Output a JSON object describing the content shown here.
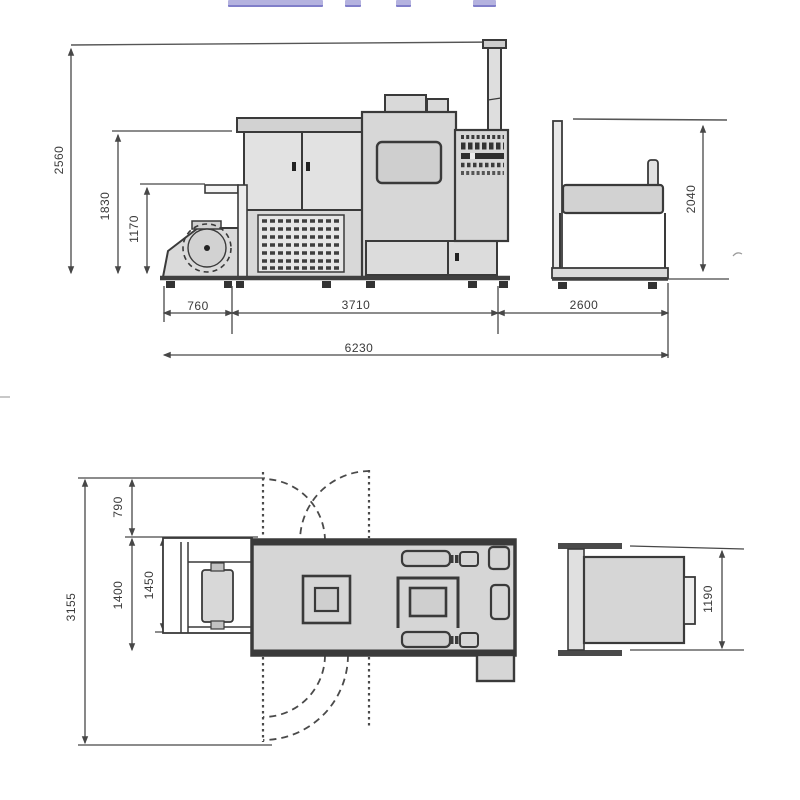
{
  "colors": {
    "accent_bar": "#b4b2df",
    "accent_bar_edge": "#807ec9",
    "machine_fill": "#d6d6d6",
    "outline": "#3a3a3a",
    "dimension_line": "#474747"
  },
  "elevation_view": {
    "dims": {
      "height_overall": "2560",
      "height_body": "1830",
      "height_feeder": "1170",
      "height_delivery": "2040",
      "length_feeder": "760",
      "length_body": "3710",
      "length_delivery": "2600",
      "length_overall": "6230"
    }
  },
  "plan_view": {
    "dims": {
      "depth_rear": "790",
      "depth_overall": "3155",
      "depth_body": "1400",
      "depth_feeder": "1450",
      "depth_delivery": "1190"
    }
  }
}
